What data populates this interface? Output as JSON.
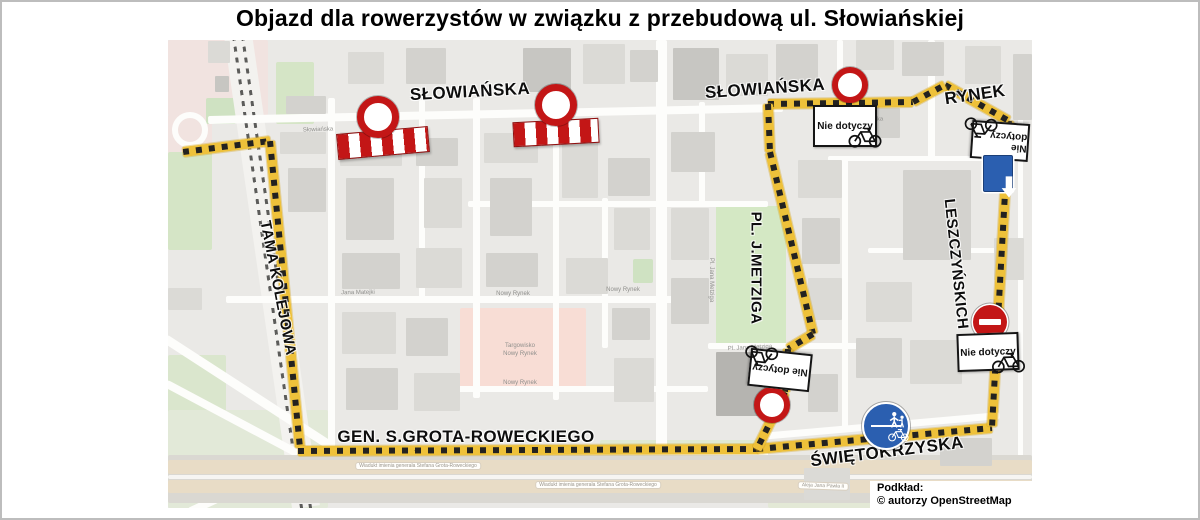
{
  "title": "Objazd dla rowerzystów w związku z przebudową ul. Słowiańskiej",
  "attribution": {
    "line1": "Podkład:",
    "line2": "© autorzy OpenStreetMap"
  },
  "colors": {
    "route_yellow": "#eec13a",
    "route_dash": "#232220",
    "sign_red": "#c31616",
    "sign_blue": "#2b5fb0",
    "map_bg": "#eae9e6",
    "park_green": "#d4e8c4",
    "market_pink": "#f8ddd5",
    "building_shades": [
      "#dbdad6",
      "#d3d2ce",
      "#c7c6c2",
      "#b5b4b0"
    ]
  },
  "map": {
    "labels": [
      {
        "id": "slowianska-west",
        "text": "SŁOWIAŃSKA",
        "x": 302,
        "y": 52,
        "rot": -3,
        "size": 17
      },
      {
        "id": "slowianska-east",
        "text": "SŁOWIAŃSKA",
        "x": 597,
        "y": 49,
        "rot": -4,
        "size": 17
      },
      {
        "id": "rynek",
        "text": "RYNEK",
        "x": 807,
        "y": 55,
        "rot": -8,
        "size": 17
      },
      {
        "id": "tama-kolejowa",
        "text": "TAMA KOLEJOWA",
        "x": 110,
        "y": 248,
        "rot": 79,
        "size": 15
      },
      {
        "id": "pl-j-metziga",
        "text": "PL. J.METZIGA",
        "x": 588,
        "y": 228,
        "rot": 90,
        "size": 15
      },
      {
        "id": "leszczynskich",
        "text": "LESZCZYŃSKICH",
        "x": 788,
        "y": 224,
        "rot": 84,
        "size": 15
      },
      {
        "id": "grota-roweckiego",
        "text": "GEN. S.GROTA-ROWECKIEGO",
        "x": 298,
        "y": 397,
        "rot": 0,
        "size": 17
      },
      {
        "id": "swietokrzyska",
        "text": "ŚWIĘTOKRZYSKA",
        "x": 719,
        "y": 412,
        "rot": -7,
        "size": 17
      }
    ],
    "micro_labels": [
      {
        "t": "Słowiańska",
        "x": 150,
        "y": 90,
        "r": -2
      },
      {
        "t": "Słowiańska",
        "x": 700,
        "y": 80,
        "r": -2
      },
      {
        "t": "Jana Matejki",
        "x": 190,
        "y": 253,
        "r": -1
      },
      {
        "t": "Nowy Rynek",
        "x": 345,
        "y": 254,
        "r": 0
      },
      {
        "t": "Nowy Rynek",
        "x": 455,
        "y": 250,
        "r": 0
      },
      {
        "t": "Targowisko",
        "x": 352,
        "y": 306,
        "r": 0
      },
      {
        "t": "Nowy Rynek",
        "x": 352,
        "y": 314,
        "r": 0
      },
      {
        "t": "Nowy Rynek",
        "x": 352,
        "y": 343,
        "r": 0
      },
      {
        "t": "Pl. Jana Metziga",
        "x": 543,
        "y": 240,
        "r": 90
      },
      {
        "t": "Pl. Jana Metziga",
        "x": 582,
        "y": 308,
        "r": -3
      },
      {
        "t": "Wiadukt imienia generała Stefana Grota-Roweckiego",
        "x": 250,
        "y": 426,
        "r": 0,
        "box": 1
      },
      {
        "t": "Wiadukt imienia generała Stefana Grota-Roweckiego",
        "x": 430,
        "y": 445,
        "r": 0,
        "box": 1
      },
      {
        "t": "Aleja Jana Pawła II",
        "x": 655,
        "y": 446,
        "r": 2,
        "box": 1
      }
    ],
    "route_segments": [
      {
        "x1": 15,
        "y1": 112,
        "x2": 102,
        "y2": 101
      },
      {
        "x1": 102,
        "y1": 101,
        "x2": 132,
        "y2": 408
      },
      {
        "x1": 130,
        "y1": 411,
        "x2": 591,
        "y2": 409
      },
      {
        "x1": 589,
        "y1": 409,
        "x2": 824,
        "y2": 388
      },
      {
        "x1": 841,
        "y1": 81,
        "x2": 824,
        "y2": 387
      },
      {
        "x1": 777,
        "y1": 45,
        "x2": 841,
        "y2": 81
      },
      {
        "x1": 600,
        "y1": 64,
        "x2": 745,
        "y2": 62
      },
      {
        "x1": 745,
        "y1": 62,
        "x2": 777,
        "y2": 45
      },
      {
        "x1": 600,
        "y1": 64,
        "x2": 602,
        "y2": 112
      },
      {
        "x1": 602,
        "y1": 112,
        "x2": 645,
        "y2": 294
      },
      {
        "x1": 645,
        "y1": 294,
        "x2": 620,
        "y2": 309
      },
      {
        "x1": 620,
        "y1": 309,
        "x2": 617,
        "y2": 352
      },
      {
        "x1": 617,
        "y1": 352,
        "x2": 589,
        "y2": 409
      }
    ],
    "signs": [
      {
        "type": "barrier",
        "name": "barrier-sign",
        "x": 215,
        "y": 103,
        "w": 92,
        "h": 26,
        "rot": -5
      },
      {
        "type": "barrier",
        "name": "barrier-sign",
        "x": 388,
        "y": 92,
        "w": 86,
        "h": 25,
        "rot": -3
      },
      {
        "type": "novehicles",
        "name": "no-vehicles-sign",
        "x": 210,
        "y": 77,
        "r": 21
      },
      {
        "type": "novehicles",
        "name": "no-vehicles-sign",
        "x": 388,
        "y": 65,
        "r": 21
      },
      {
        "type": "novehicles",
        "name": "no-vehicles-sign",
        "x": 682,
        "y": 45,
        "r": 18
      },
      {
        "type": "nd",
        "name": "nie-dotyczy-sign",
        "x": 677,
        "y": 86,
        "w": 64,
        "h": 42,
        "rot": 0,
        "text": "Nie dotyczy"
      },
      {
        "type": "nd",
        "name": "nie-dotyczy-sign",
        "x": 832,
        "y": 101,
        "w": 58,
        "h": 38,
        "rot": 184,
        "text": "Nie dotyczy"
      },
      {
        "type": "oneway",
        "name": "one-way-sign",
        "x": 830,
        "y": 133,
        "w": 30,
        "h": 37
      },
      {
        "type": "noentry",
        "name": "no-entry-sign",
        "x": 822,
        "y": 282,
        "r": 17
      },
      {
        "type": "nd",
        "name": "nie-dotyczy-sign",
        "x": 820,
        "y": 312,
        "w": 62,
        "h": 38,
        "rot": -2,
        "text": "Nie dotyczy"
      },
      {
        "type": "nd",
        "name": "nie-dotyczy-sign",
        "x": 612,
        "y": 330,
        "w": 62,
        "h": 38,
        "rot": 186,
        "text": "Nie dotyczy"
      },
      {
        "type": "novehicles",
        "name": "no-vehicles-sign",
        "x": 604,
        "y": 365,
        "r": 18
      },
      {
        "type": "shared",
        "name": "shared-path-sign",
        "x": 718,
        "y": 386,
        "r": 24
      }
    ],
    "patches": [
      {
        "x": 0,
        "y": 0,
        "w": 100,
        "h": 75,
        "c": "#f1e3e0"
      },
      {
        "x": 0,
        "y": 75,
        "w": 44,
        "h": 40,
        "c": "#f1e3e0"
      },
      {
        "x": 38,
        "y": 58,
        "w": 30,
        "h": 26,
        "c": "#cfe2c2"
      },
      {
        "x": 108,
        "y": 22,
        "w": 38,
        "h": 62,
        "c": "#d5e5c6"
      },
      {
        "x": 0,
        "y": 112,
        "w": 44,
        "h": 98,
        "c": "#d5e5c6"
      },
      {
        "x": 0,
        "y": 315,
        "w": 58,
        "h": 95,
        "c": "#dae6cd"
      },
      {
        "x": 24,
        "y": 428,
        "w": 66,
        "h": 36,
        "c": "#d5e5c6"
      },
      {
        "x": 0,
        "y": 370,
        "w": 160,
        "h": 98,
        "c": "#e2e9d8"
      },
      {
        "x": 548,
        "y": 166,
        "w": 70,
        "h": 140,
        "c": "#d4e8c4"
      },
      {
        "x": 432,
        "y": 400,
        "w": 165,
        "h": 34,
        "c": "#dfe9d2"
      },
      {
        "x": 600,
        "y": 435,
        "w": 110,
        "h": 33,
        "c": "#e3e9d6"
      },
      {
        "x": 465,
        "y": 219,
        "w": 20,
        "h": 24,
        "c": "#cfe2c2"
      },
      {
        "x": 292,
        "y": 268,
        "w": 126,
        "h": 84,
        "c": "#f8ddd5"
      }
    ],
    "streets": [
      {
        "x": 0,
        "y": 295,
        "w": 200,
        "h": 9,
        "rot": 33
      },
      {
        "x": 0,
        "y": 340,
        "w": 150,
        "h": 8,
        "rot": 28
      },
      {
        "x": 20,
        "y": 468,
        "w": 130,
        "h": 8,
        "rot": -25
      },
      {
        "x": 40,
        "y": 76,
        "w": 575,
        "h": 8,
        "rot": -1.2
      },
      {
        "x": 160,
        "y": 58,
        "w": 7,
        "h": 352
      },
      {
        "x": 251,
        "y": 60,
        "w": 6,
        "h": 202
      },
      {
        "x": 305,
        "y": 58,
        "w": 7,
        "h": 300
      },
      {
        "x": 385,
        "y": 60,
        "w": 6,
        "h": 300
      },
      {
        "x": 434,
        "y": 158,
        "w": 6,
        "h": 150
      },
      {
        "x": 488,
        "y": 0,
        "w": 11,
        "h": 418
      },
      {
        "x": 531,
        "y": 62,
        "w": 6,
        "h": 104
      },
      {
        "x": 669,
        "y": 0,
        "w": 6,
        "h": 62
      },
      {
        "x": 674,
        "y": 118,
        "w": 6,
        "h": 272
      },
      {
        "x": 760,
        "y": 0,
        "w": 7,
        "h": 118
      },
      {
        "x": 850,
        "y": 78,
        "w": 5,
        "h": 340
      },
      {
        "x": 300,
        "y": 161,
        "w": 300,
        "h": 6
      },
      {
        "x": 58,
        "y": 256,
        "w": 480,
        "h": 7
      },
      {
        "x": 540,
        "y": 303,
        "w": 160,
        "h": 6
      },
      {
        "x": 278,
        "y": 346,
        "w": 262,
        "h": 6
      },
      {
        "x": 128,
        "y": 410,
        "w": 472,
        "h": 8
      },
      {
        "x": 592,
        "y": 393,
        "w": 240,
        "h": 7,
        "rot": -5
      },
      {
        "x": 660,
        "y": 116,
        "w": 190,
        "h": 5
      },
      {
        "x": 700,
        "y": 208,
        "w": 150,
        "h": 5
      },
      {
        "x": 0,
        "y": 415,
        "w": 864,
        "h": 48,
        "c": "#dad8d2"
      },
      {
        "x": 0,
        "y": 420,
        "w": 864,
        "h": 14,
        "c": "#e8dcc6"
      },
      {
        "x": 0,
        "y": 435,
        "w": 864,
        "h": 4,
        "c": "#f6f5f2"
      },
      {
        "x": 0,
        "y": 440,
        "w": 864,
        "h": 13,
        "c": "#e8dcc6"
      }
    ],
    "rail": {
      "bed": {
        "x": 56,
        "y": -4,
        "w": 28,
        "h": 478,
        "rot": -8.2
      },
      "lines": [
        {
          "x": 64,
          "y": -4,
          "h": 478,
          "rot": -8.2
        },
        {
          "x": 73,
          "y": -4,
          "h": 478,
          "rot": -8.2
        }
      ]
    },
    "roundabout": {
      "x": 4,
      "y": 72,
      "w": 36,
      "h": 36
    },
    "buildings": [
      [
        40,
        1,
        22,
        22,
        0
      ],
      [
        47,
        36,
        14,
        16,
        2
      ],
      [
        118,
        56,
        40,
        18,
        1
      ],
      [
        112,
        92,
        46,
        22,
        0
      ],
      [
        120,
        128,
        38,
        44,
        1
      ],
      [
        0,
        248,
        34,
        22,
        0
      ],
      [
        180,
        12,
        36,
        32,
        0
      ],
      [
        238,
        8,
        40,
        36,
        1
      ],
      [
        355,
        8,
        48,
        44,
        2
      ],
      [
        415,
        4,
        42,
        40,
        0
      ],
      [
        462,
        10,
        28,
        32,
        1
      ],
      [
        172,
        92,
        62,
        34,
        0
      ],
      [
        178,
        138,
        48,
        62,
        1
      ],
      [
        248,
        98,
        42,
        28,
        1
      ],
      [
        256,
        138,
        38,
        50,
        0
      ],
      [
        316,
        93,
        54,
        30,
        0
      ],
      [
        322,
        138,
        42,
        58,
        1
      ],
      [
        394,
        96,
        36,
        62,
        0
      ],
      [
        440,
        118,
        42,
        38,
        1
      ],
      [
        446,
        168,
        36,
        42,
        0
      ],
      [
        174,
        213,
        58,
        36,
        1
      ],
      [
        248,
        208,
        46,
        40,
        0
      ],
      [
        318,
        213,
        52,
        34,
        1
      ],
      [
        398,
        218,
        42,
        36,
        0
      ],
      [
        174,
        272,
        54,
        42,
        0
      ],
      [
        238,
        278,
        42,
        38,
        1
      ],
      [
        178,
        328,
        52,
        42,
        1
      ],
      [
        246,
        333,
        46,
        38,
        0
      ],
      [
        444,
        268,
        38,
        32,
        1
      ],
      [
        446,
        318,
        40,
        44,
        0
      ],
      [
        505,
        8,
        46,
        52,
        2
      ],
      [
        558,
        14,
        42,
        42,
        0
      ],
      [
        608,
        4,
        42,
        46,
        1
      ],
      [
        503,
        92,
        44,
        40,
        1
      ],
      [
        503,
        168,
        38,
        52,
        0
      ],
      [
        503,
        238,
        38,
        46,
        1
      ],
      [
        630,
        120,
        44,
        38,
        0
      ],
      [
        634,
        178,
        38,
        46,
        1
      ],
      [
        640,
        238,
        34,
        42,
        0
      ],
      [
        548,
        312,
        58,
        64,
        3
      ],
      [
        640,
        334,
        30,
        38,
        1
      ],
      [
        688,
        0,
        38,
        30,
        0
      ],
      [
        734,
        2,
        42,
        34,
        1
      ],
      [
        797,
        6,
        36,
        38,
        0
      ],
      [
        845,
        14,
        19,
        66,
        1
      ],
      [
        700,
        68,
        32,
        30,
        1
      ],
      [
        735,
        130,
        68,
        90,
        1
      ],
      [
        826,
        198,
        30,
        42,
        0
      ],
      [
        698,
        242,
        46,
        40,
        0
      ],
      [
        688,
        298,
        46,
        40,
        1
      ],
      [
        742,
        300,
        52,
        44,
        0
      ],
      [
        636,
        428,
        46,
        32,
        0
      ],
      [
        772,
        398,
        52,
        28,
        1
      ]
    ]
  }
}
